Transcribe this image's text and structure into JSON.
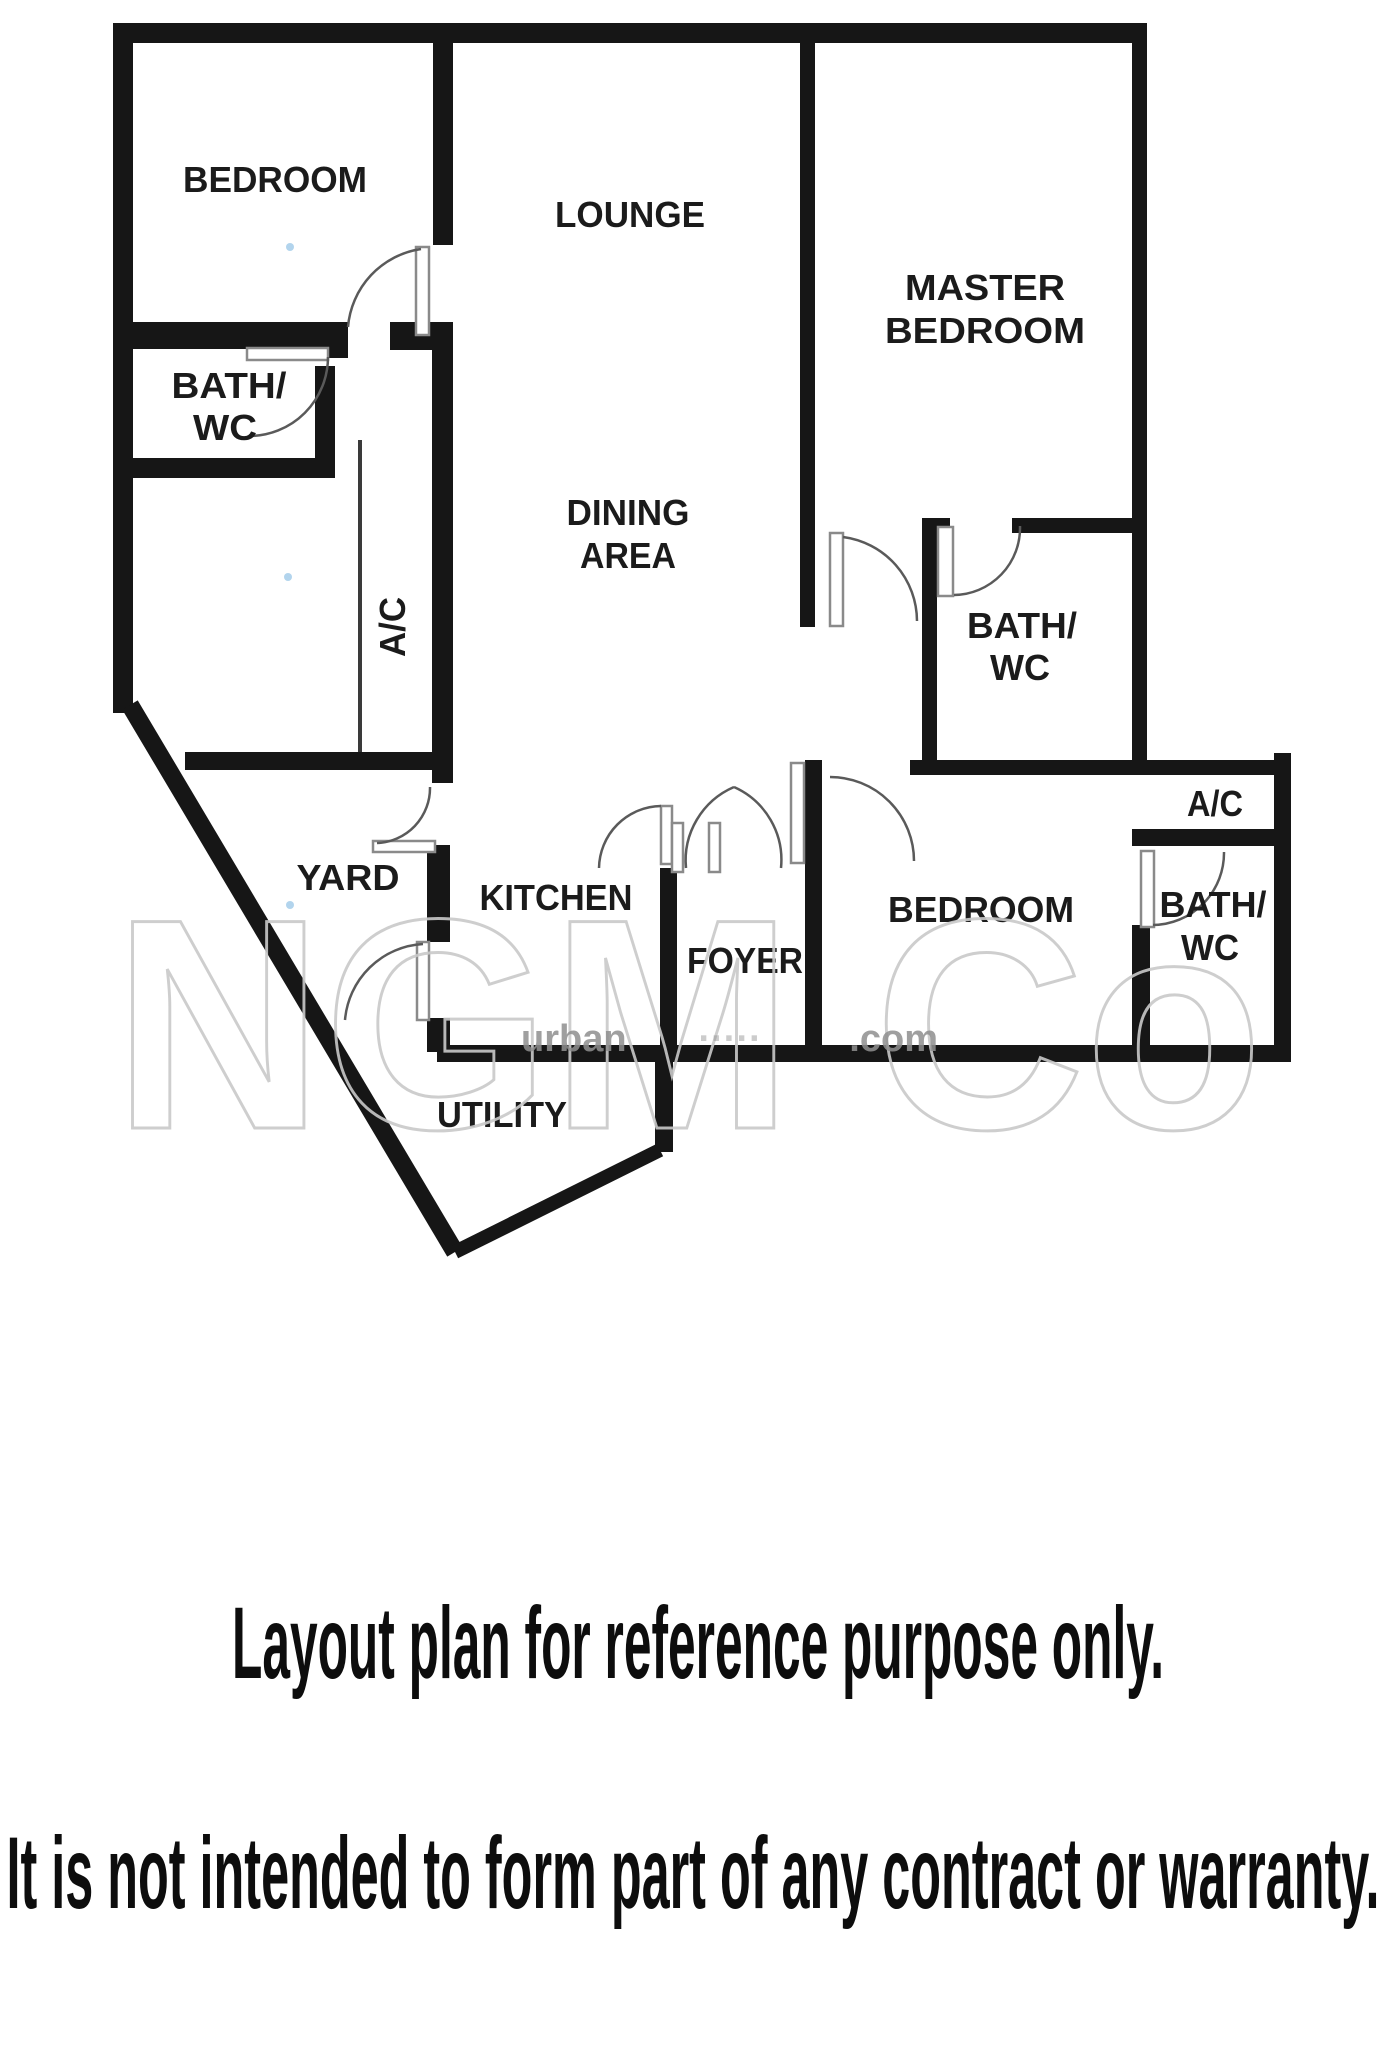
{
  "plan": {
    "labels": [
      {
        "text": "BEDROOM"
      },
      {
        "text": "LOUNGE"
      },
      {
        "text": "MASTER"
      },
      {
        "text": "BEDROOM"
      },
      {
        "text": "BATH/"
      },
      {
        "text": "WC"
      },
      {
        "text": "DINING"
      },
      {
        "text": "AREA"
      },
      {
        "text": "A/C"
      },
      {
        "text": "BATH/"
      },
      {
        "text": "WC"
      },
      {
        "text": "YARD"
      },
      {
        "text": "KITCHEN"
      },
      {
        "text": "FOYER"
      },
      {
        "text": "BEDROOM"
      },
      {
        "text": "A/C"
      },
      {
        "text": "BATH/"
      },
      {
        "text": "WC"
      },
      {
        "text": "UTILITY"
      }
    ]
  },
  "watermark": {
    "main": "NGM Co",
    "url_start": "urban",
    "url_mid": "·····",
    "url_end": ".com"
  },
  "captions": {
    "line1": "Layout plan for reference purpose only.",
    "line2": "It is not intended to form part of any contract or warranty."
  }
}
